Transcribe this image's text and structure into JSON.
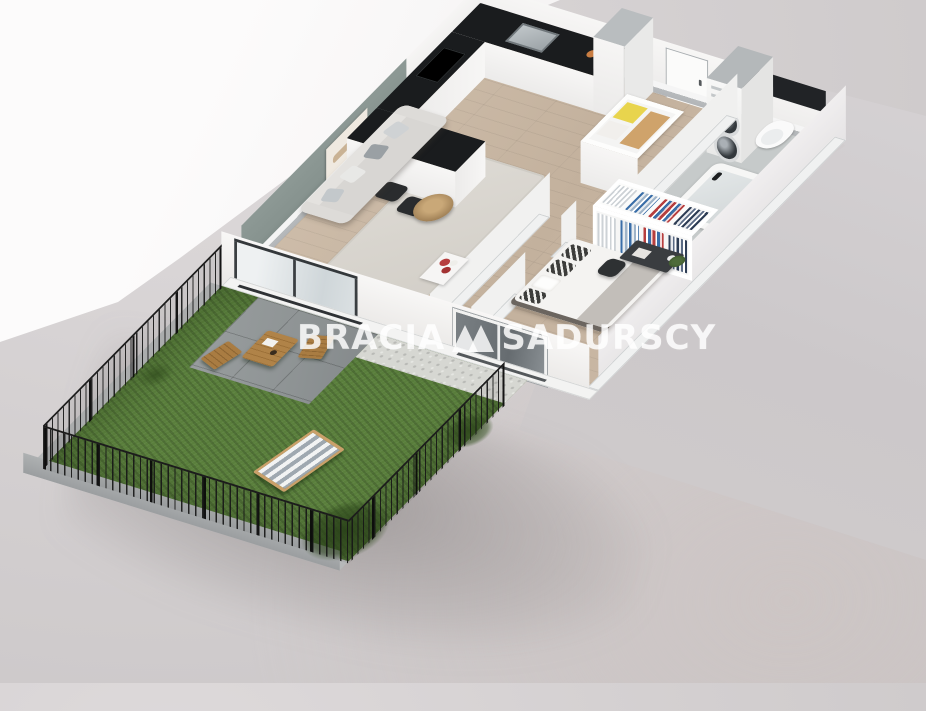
{
  "watermark": {
    "brand_left": "BRACIA",
    "brand_right": "SADURSCY",
    "logo_icon": "double-triangle-logo"
  },
  "colors": {
    "floor_wood": "#cdbca9",
    "floor_bath": "#c6caca",
    "wall_top_gray": "#b7babc",
    "accent_wall": "#87938f",
    "countertop": "#1a1c1e",
    "black_strip": "#212326",
    "grass": "#5a7f3c",
    "terrace": "#8e9394",
    "gravel": "#d6d7d2",
    "fence": "#1f1f1f",
    "clothes_blue": "#3a6ea8",
    "clothes_red": "#b63e3e",
    "clothes_navy": "#2e3d55",
    "towel_yellow": "#e8d44d",
    "towel_tan": "#cfa36b",
    "wood_furniture": "#b08348",
    "watermark": "rgba(255,255,255,0.82)"
  },
  "scene": {
    "type": "3d-floorplan-render",
    "rooms": [
      {
        "name": "kitchen",
        "items": [
          "l-shaped-black-counter",
          "sink",
          "cooktop",
          "breakfast-peninsula",
          "bar-stools-x3",
          "tall-cabinet"
        ]
      },
      {
        "name": "living-room",
        "items": [
          "sage-accent-wall",
          "wall-art",
          "gray-sofa",
          "throw-pillows",
          "rug",
          "round-coffee-table",
          "flower-cabinet"
        ]
      },
      {
        "name": "hallway",
        "items": [
          "entrance-door",
          "linen-shelf-yellow-towels"
        ]
      },
      {
        "name": "bathroom",
        "items": [
          "stacked-washer-dryer",
          "toilet",
          "bathtub",
          "black-accent-strip"
        ]
      },
      {
        "name": "wardrobe",
        "items": [
          "open-closet-hanging-clothes"
        ]
      },
      {
        "name": "bedroom",
        "items": [
          "double-bed",
          "patterned-pillows",
          "desk",
          "desk-chair",
          "plant",
          "front-window"
        ]
      },
      {
        "name": "garden",
        "items": [
          "lawn",
          "paved-terrace",
          "gravel-strip",
          "black-metal-fence",
          "concrete-curb",
          "wooden-bistro-table",
          "folding-chairs-x2",
          "striped-deck-chair",
          "ornamental-grasses"
        ]
      }
    ]
  }
}
